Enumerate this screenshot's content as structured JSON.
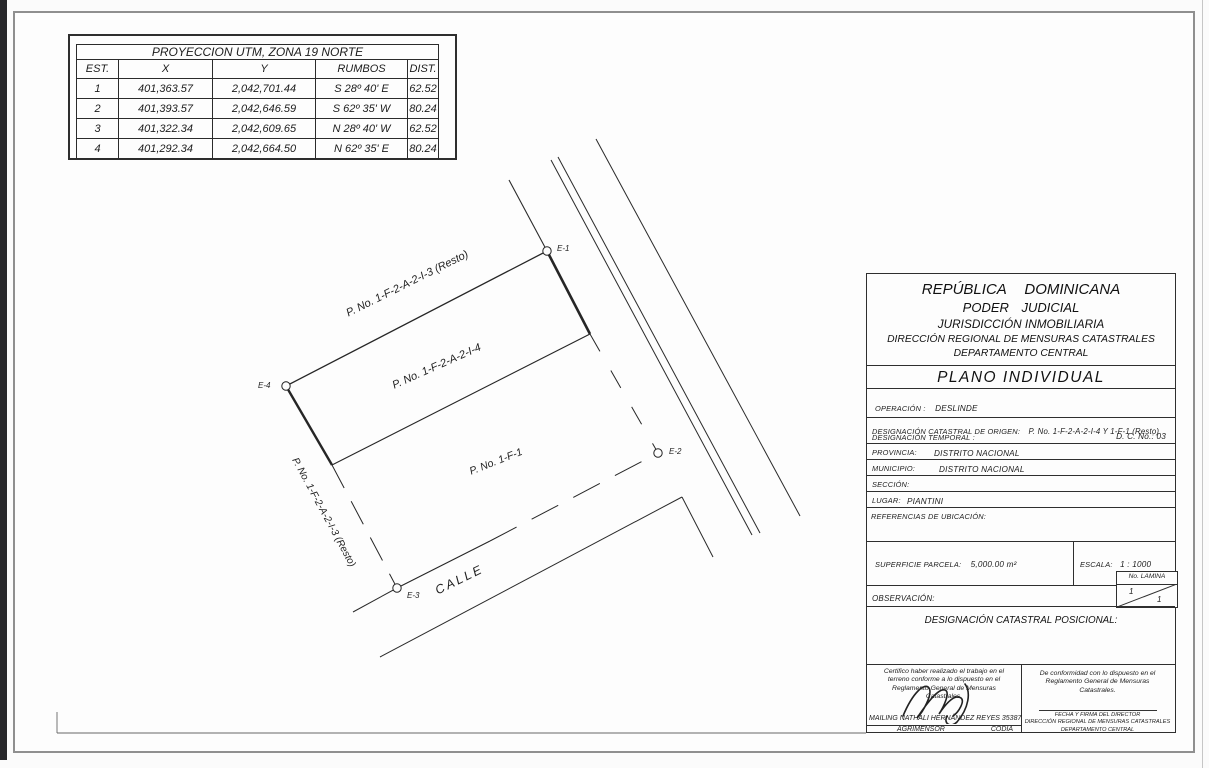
{
  "utm_table": {
    "title": "PROYECCION UTM, ZONA 19 NORTE",
    "headers": [
      "EST.",
      "X",
      "Y",
      "RUMBOS",
      "DIST."
    ],
    "rows": [
      {
        "est": "1",
        "x": "401,363.57",
        "y": "2,042,701.44",
        "rumbos": "S 28º 40' E",
        "dist": "62.52"
      },
      {
        "est": "2",
        "x": "401,393.57",
        "y": "2,042,646.59",
        "rumbos": "S 62º 35' W",
        "dist": "80.24"
      },
      {
        "est": "3",
        "x": "401,322.34",
        "y": "2,042,609.65",
        "rumbos": "N 28º 40' W",
        "dist": "62.52"
      },
      {
        "est": "4",
        "x": "401,292.34",
        "y": "2,042,664.50",
        "rumbos": "N 62º 35' E",
        "dist": "80.24"
      }
    ]
  },
  "drawing": {
    "labels": {
      "parcel_top": "P. No. 1-F-2-A-2-I-3 (Resto)",
      "parcel_mid": "P. No. 1-F-2-A-2-I-4",
      "parcel_bottom": "P. No. 1-F-1",
      "parcel_left": "P. No. 1-F-2-A-2-I-3 (Resto)",
      "street": "CALLE"
    },
    "stations": {
      "e1": "E-1",
      "e2": "E-2",
      "e3": "E-3",
      "e4": "E-4"
    }
  },
  "title_block": {
    "header_lines": [
      "REPÚBLICA DOMINICANA",
      "PODER JUDICIAL",
      "JURISDICCIÓN INMOBILIARIA",
      "DIRECCIÓN REGIONAL DE MENSURAS CATASTRALES",
      "DEPARTAMENTO CENTRAL"
    ],
    "plan_type": "PLANO INDIVIDUAL",
    "fields": {
      "operacion_label": "OPERACIÓN :",
      "operacion_value": "DESLINDE",
      "origen_label": "DESIGNACIÓN CATASTRAL DE ORIGEN:",
      "origen_value": "P. No. 1-F-2-A-2-I-4 Y 1-F-1 (Resto)",
      "temporal_label": "DESIGNACIÓN TEMPORAL :",
      "dc_no": "D. C. No.: 03",
      "provincia_label": "PROVINCIA:",
      "provincia_value": "DISTRITO NACIONAL",
      "municipio_label": "MUNICIPIO:",
      "municipio_value": "DISTRITO NACIONAL",
      "seccion_label": "SECCIÓN:",
      "lugar_label": "LUGAR:",
      "lugar_value": "PIANTINI",
      "referencias_label": "REFERENCIAS DE UBICACIÓN:",
      "superficie_label": "SUPERFICIE PARCELA:",
      "superficie_value": "5,000.00 m²",
      "escala_label": "ESCALA:",
      "escala_value": "1 : 1000",
      "observacion_label": "OBSERVACIÓN:",
      "lamina_label": "No. LAMINA",
      "lamina_top": "1",
      "lamina_bottom": "1",
      "posicional_label": "DESIGNACIÓN CATASTRAL POSICIONAL:"
    },
    "certification": {
      "left_text": "Certifico haber realizado el trabajo en el terreno conforme a lo dispuesto en el Reglamento General de Mensuras Catastrales.",
      "surveyor_name": "MAILING NATHALI HERNÁNDEZ REYES 35387",
      "surveyor_title": "AGRIMENSOR",
      "codia": "CODIA",
      "right_text": "De conformidad con lo dispuesto en el Reglamento General de Mensuras Catastrales.",
      "director_line1": "FECHA Y FIRMA DEL DIRECTOR",
      "director_line2": "DIRECCIÓN REGIONAL DE MENSURAS CATASTRALES",
      "director_line3": "DEPARTAMENTO CENTRAL"
    }
  }
}
